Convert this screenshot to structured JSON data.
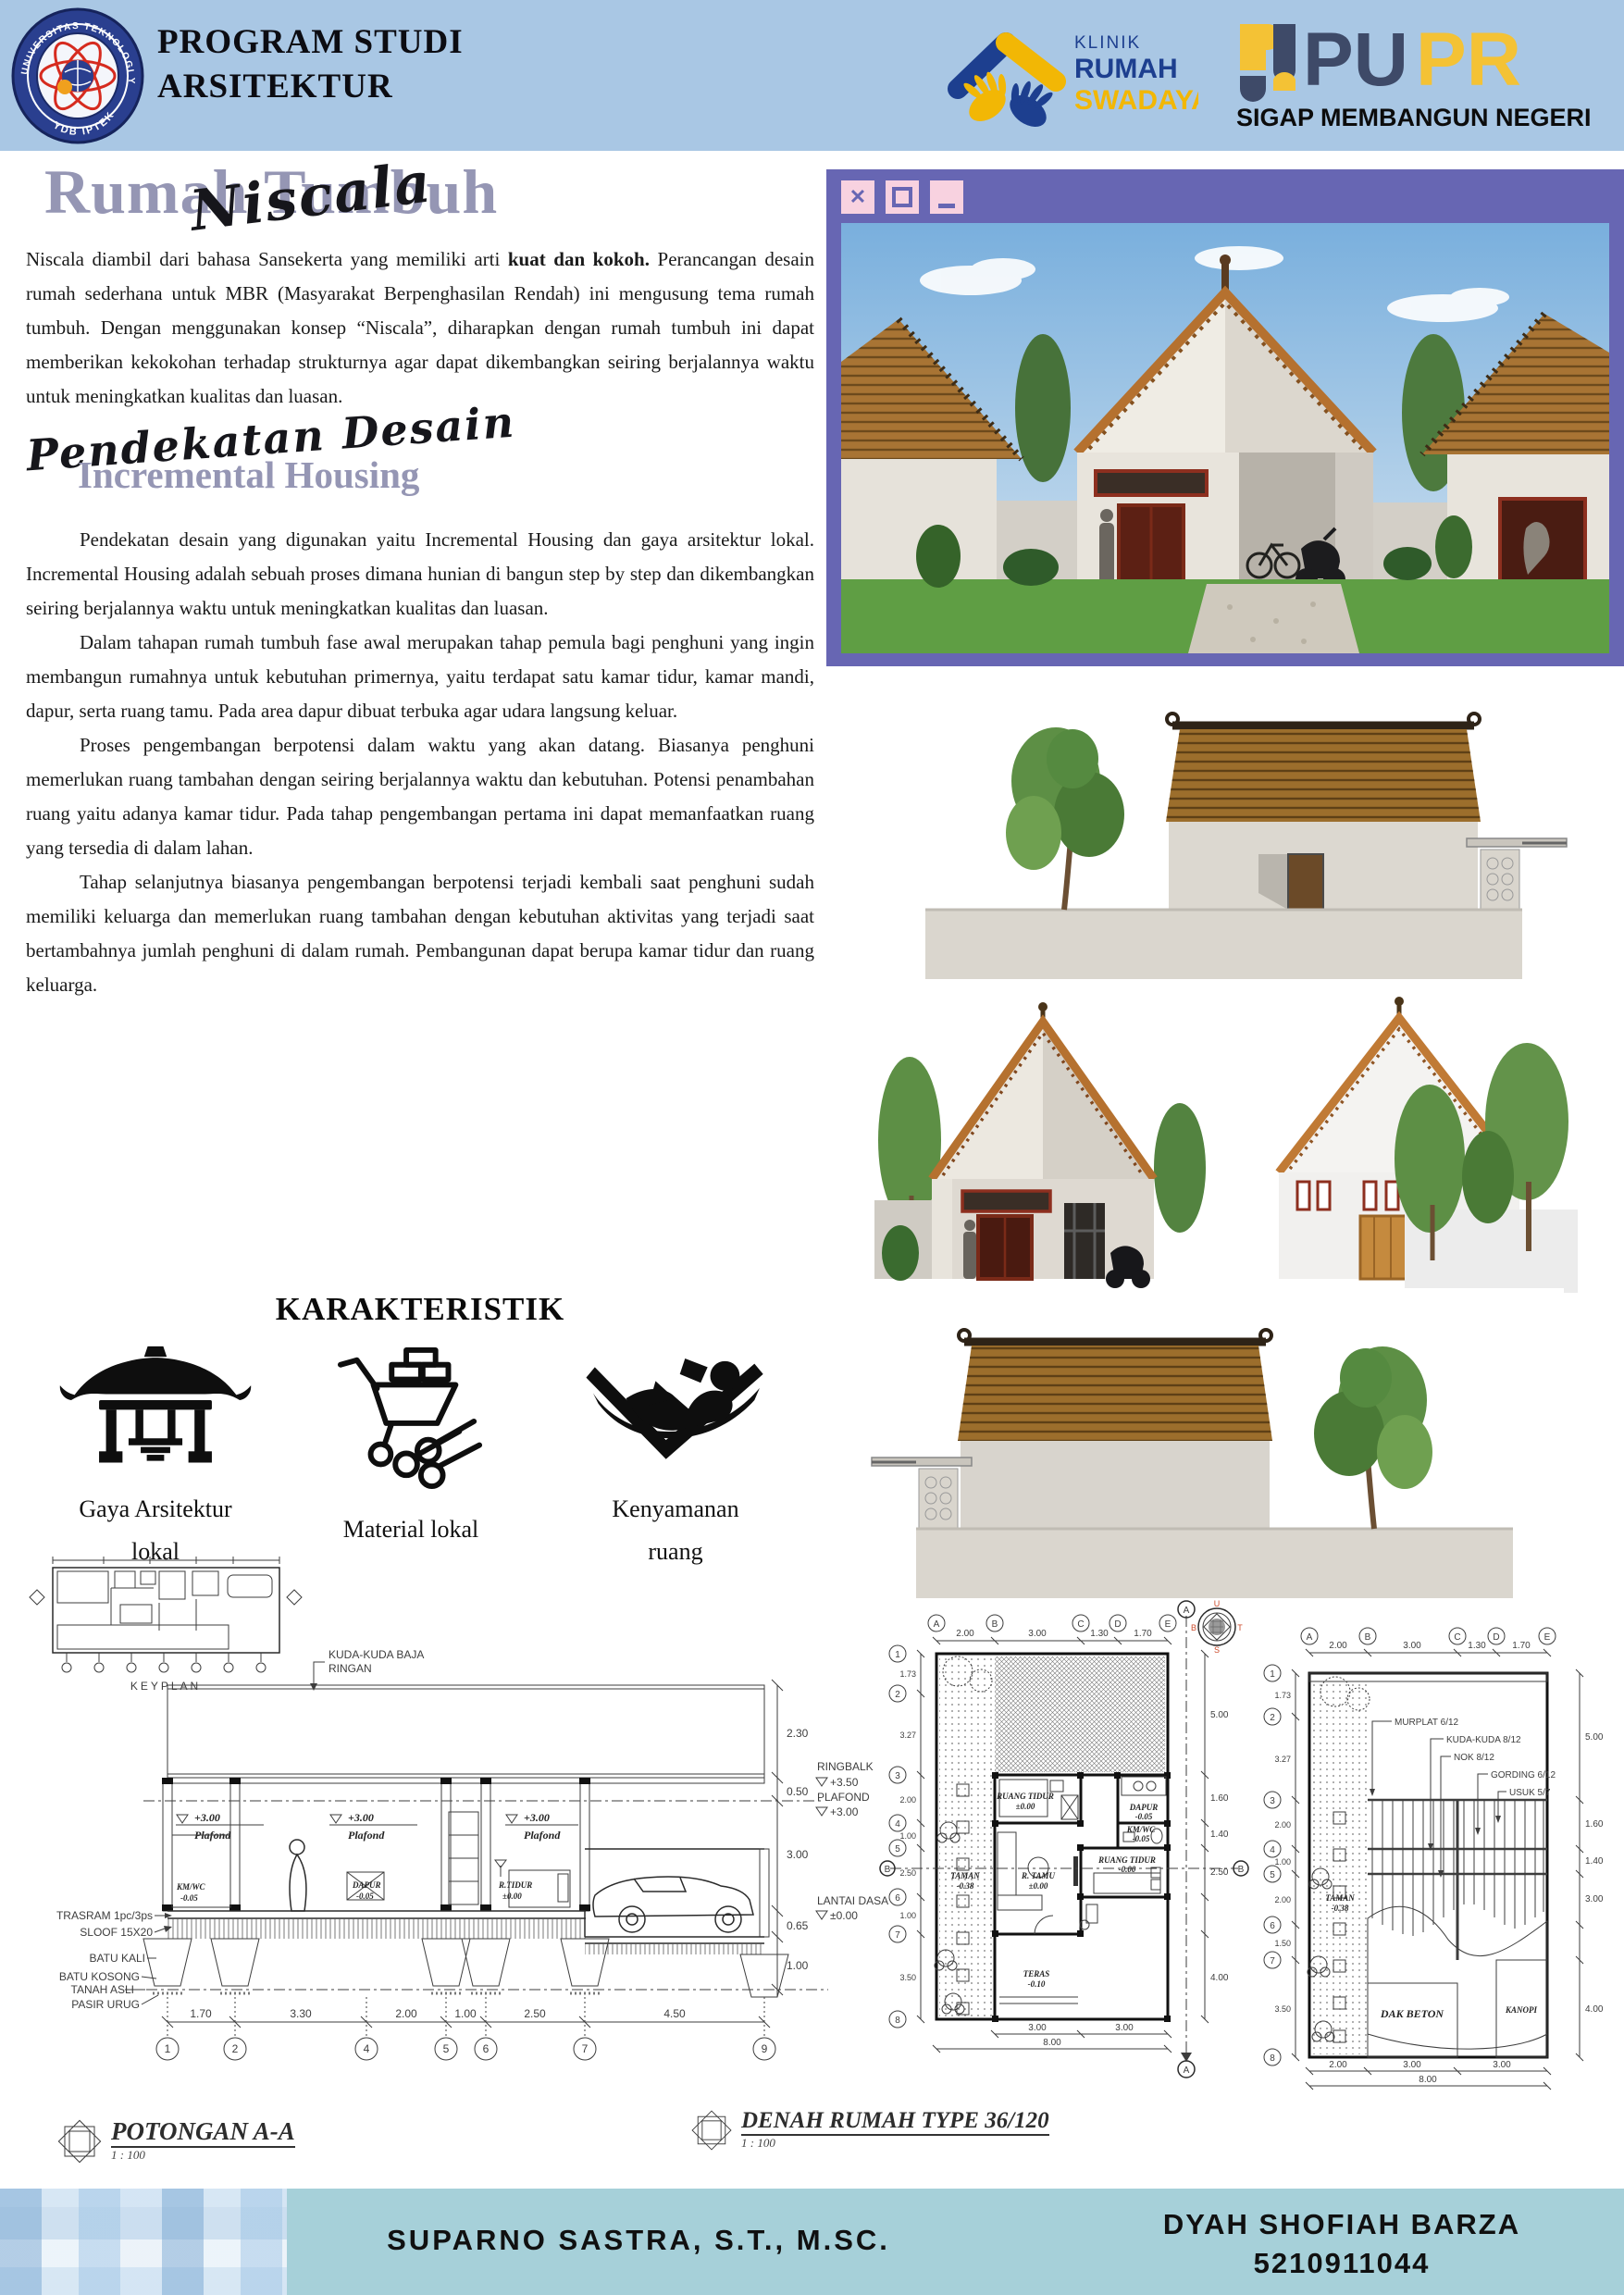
{
  "header": {
    "bg": "#a9c7e4",
    "title1": "PROGRAM STUDI",
    "title2": "ARSITEKTUR",
    "uty_ring": "UNIVERSITAS TEKNOLOGI YOGYAKARTA",
    "uty_bottom": "YDB IPTEK",
    "klinik": {
      "l1": "KLINIK",
      "l2": "RUMAH",
      "l3": "SWADAYA",
      "navy": "#1d3f8f",
      "yellow": "#f2b705"
    },
    "pupr": {
      "pu": "PU",
      "pr": "PR",
      "tag": "SIGAP MEMBANGUN NEGERI",
      "navy": "#3e4a68",
      "yellow": "#f4c235"
    }
  },
  "hero": {
    "title": "Rumah Tumbuh",
    "script": "Niscala",
    "title_color": "#9596b4"
  },
  "intro": {
    "lead": "Niscala diambil dari bahasa Sansekerta yang memiliki arti ",
    "bold": "kuat dan kokoh.",
    "rest": " Perancangan desain rumah sederhana untuk MBR (Masyarakat Berpenghasilan Rendah) ini mengusung tema rumah tumbuh. Dengan menggunakan konsep “Niscala”,  diharapkan dengan rumah tumbuh ini dapat memberikan kekokohan terhadap strukturnya agar dapat dikembangkan seiring berjalannya waktu untuk meningkatkan kualitas dan luasan."
  },
  "sec2": {
    "script": "Pendekatan Desain",
    "title": "Incremental Housing"
  },
  "paras": {
    "p2": "Pendekatan desain yang digunakan yaitu Incremental Housing dan gaya arsitektur lokal. Incremental Housing adalah sebuah proses dimana hunian di bangun step by step dan dikembangkan seiring berjalannya waktu untuk meningkatkan kualitas dan luasan.",
    "p3": "Dalam tahapan rumah tumbuh fase awal merupakan tahap pemula bagi penghuni yang ingin membangun rumahnya untuk kebutuhan primernya, yaitu terdapat satu kamar tidur, kamar mandi, dapur, serta ruang tamu. Pada area dapur dibuat terbuka agar udara langsung keluar.",
    "p4": "Proses pengembangan berpotensi dalam waktu yang akan datang. Biasanya penghuni memerlukan ruang tambahan dengan seiring berjalannya waktu dan kebutuhan. Potensi penambahan ruang yaitu adanya kamar tidur. Pada tahap pengembangan pertama ini dapat memanfaatkan ruang yang tersedia di dalam lahan.",
    "p5": "Tahap selanjutnya biasanya pengembangan berpotensi terjadi kembali saat penghuni sudah memiliki keluarga dan memerlukan ruang tambahan dengan kebutuhan aktivitas yang terjadi saat bertambahnya jumlah penghuni di dalam rumah. Pembangunan dapat berupa kamar tidur dan ruang keluarga."
  },
  "karak": {
    "title": "KARAKTERISTIK",
    "items": [
      {
        "icon": "javanese-pavilion",
        "l1": "Gaya Arsitektur",
        "l2": "lokal"
      },
      {
        "icon": "wheelbarrow-logs",
        "l1": "Material lokal",
        "l2": ""
      },
      {
        "icon": "person-relaxing",
        "l1": "Kenyamanan",
        "l2": "ruang"
      }
    ]
  },
  "keyplan": {
    "label": "KEYPLAN"
  },
  "window": {
    "frame_color": "#6766b3",
    "button_color": "#f8d2e0",
    "close": "close",
    "maximize": "maximize",
    "minimize": "minimize"
  },
  "pot": {
    "title": "POTONGAN A-A",
    "scale": "1 : 100",
    "truss1": "KUDA-KUDA BAJA",
    "truss2": "RINGAN",
    "plafond_lv": "+3.00",
    "plafond": "Plafond",
    "left": [
      "TRASRAM 1pc/3ps",
      "SLOOF 15X20",
      "BATU KALI",
      "BATU KOSONG",
      "TANAH ASLI",
      "PASIR URUG"
    ],
    "r_d1": "2.30",
    "r_ringbalk": "RINGBALK",
    "r_ringbalk_lv": "+3.50",
    "r_plafond": "PLAFOND",
    "r_plafond_lv": "+3.00",
    "r_d2": "0.50",
    "r_d3": "3.00",
    "r_lantai": "LANTAI DASAR",
    "r_lantai_lv": "±0.00",
    "r_d4": "0.65",
    "r_d5": "1.00",
    "kmwc": "KM/WC",
    "kmwc_lv": "-0.05",
    "dapur": "DAPUR",
    "dapur_lv": "-0.05",
    "rtidur": "R.TIDUR",
    "rtidur_lv": "±0.00",
    "dims": [
      "1.70",
      "3.30",
      "2.00",
      "1.00",
      "2.50",
      "4.50"
    ],
    "grid": [
      "1",
      "2",
      "4",
      "5",
      "6",
      "7",
      "9"
    ]
  },
  "den": {
    "title": "DENAH RUMAH TYPE 36/120",
    "scale": "1 : 100",
    "cols": [
      "A",
      "B",
      "C",
      "D",
      "E"
    ],
    "rows": [
      "1",
      "2",
      "3",
      "4",
      "5",
      "6",
      "7",
      "8"
    ],
    "tdims": [
      "2.00",
      "3.00",
      "1.30",
      "1.70"
    ],
    "ldims": [
      "1.73",
      "3.27",
      "2.00",
      "1.00",
      "2.50",
      "1.00",
      "3.50"
    ],
    "rdims": [
      "5.00",
      "1.60",
      "1.40",
      "2.50",
      "4.00"
    ],
    "bdims": [
      "3.00",
      "3.00",
      "8.00"
    ],
    "rooms": {
      "dapur": "DAPUR",
      "dapur_lv": "-0.05",
      "kmwc": "KM/WC",
      "kmwc_lv": "-0.05",
      "rt1": "RUANG TIDUR",
      "rt1_lv": "±0.00",
      "rt2": "RUANG TIDUR",
      "rt2_lv": "-0.00",
      "rtamu": "R. TAMU",
      "rtamu_lv": "±0.00",
      "taman": "TAMAN",
      "taman_lv": "-0.38",
      "teras": "TERAS",
      "teras_lv": "-0.10"
    },
    "secA": "A",
    "secB": "B"
  },
  "atap": {
    "labels": [
      "MURPLAT 6/12",
      "KUDA-KUDA 8/12",
      "NOK 8/12",
      "GORDING 6/12",
      "USUK 5/7"
    ],
    "taman": "TAMAN",
    "taman_lv": "-0.38",
    "dak": "DAK BETON",
    "kanopi": "KANOPI",
    "tdims": [
      "2.00",
      "3.00",
      "1.30",
      "1.70"
    ],
    "ldims": [
      "1.73",
      "3.27",
      "2.00",
      "1.00",
      "2.00",
      "1.50",
      "3.50"
    ],
    "rdims": [
      "5.00",
      "1.60",
      "1.40",
      "3.00",
      "4.00"
    ],
    "bdims": [
      "2.00",
      "3.00",
      "3.00",
      "8.00"
    ]
  },
  "compass": {
    "n": "U",
    "e": "T",
    "s": "S",
    "w": "B"
  },
  "footer": {
    "bg": "#a6d0d9",
    "lecturer": "SUPARNO SASTRA, S.T., M.SC.",
    "student": "DYAH SHOFIAH BARZA",
    "nim": "5210911044"
  }
}
